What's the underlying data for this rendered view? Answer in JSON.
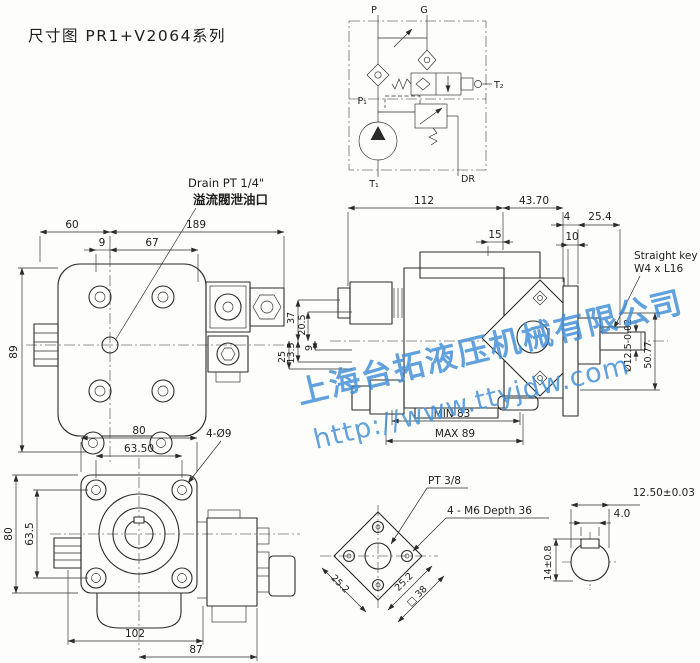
{
  "title": "尺寸图 PR1+V2064系列",
  "watermark": {
    "company": "上海台拓液压机械有限公司",
    "url": "http://www.ttyjdw.com"
  },
  "colors": {
    "line": "#2b2b28",
    "watermark_blue": "#3e8ed8",
    "paper": "#fdfdfb"
  },
  "schematic": {
    "port_p": "P",
    "port_g": "G",
    "port_p1": "P₁",
    "port_t1": "T₁",
    "port_t2": "T₂",
    "port_dr": "DR"
  },
  "front_view": {
    "drain_label_en": "Drain PT 1/4\"",
    "drain_label_cn": "溢流閥泄油口",
    "dim_60": "60",
    "dim_189": "189",
    "dim_9": "9",
    "dim_67": "67",
    "dim_89": "89"
  },
  "side_view": {
    "dim_112": "112",
    "dim_43_70": "43.70",
    "dim_4": "4",
    "dim_25_4": "25.4",
    "dim_15": "15",
    "dim_10": "10",
    "dim_37": "37",
    "dim_20_5": "20.5",
    "dim_13_5": "13.5",
    "dim_9": "9",
    "dim_25": "25",
    "dim_50_77": "50.77",
    "dim_shaft_dia": "Ø12.5-0.02",
    "dim_min": "MIN 83",
    "dim_max": "MAX 89",
    "key_label_line1": "Straight key",
    "key_label_line2": "W4 x L16"
  },
  "bottom_view": {
    "dim_80_top": "80",
    "dim_63_50": "63.50",
    "holes_label": "4-Ø9",
    "dim_80_left": "80",
    "dim_63_5": "63.5",
    "dim_102": "102",
    "dim_87": "87"
  },
  "port_flange": {
    "pt_label": "PT 3/8",
    "m6_label": "4 - M6 Depth 36",
    "dim_25_2_a": "25.2",
    "dim_25_2_b": "25.2",
    "dim_sq38": "□ 38"
  },
  "shaft_section": {
    "dim_12_50": "12.50±0.03",
    "dim_4_0": "4.0",
    "dim_14": "14±0.8"
  }
}
